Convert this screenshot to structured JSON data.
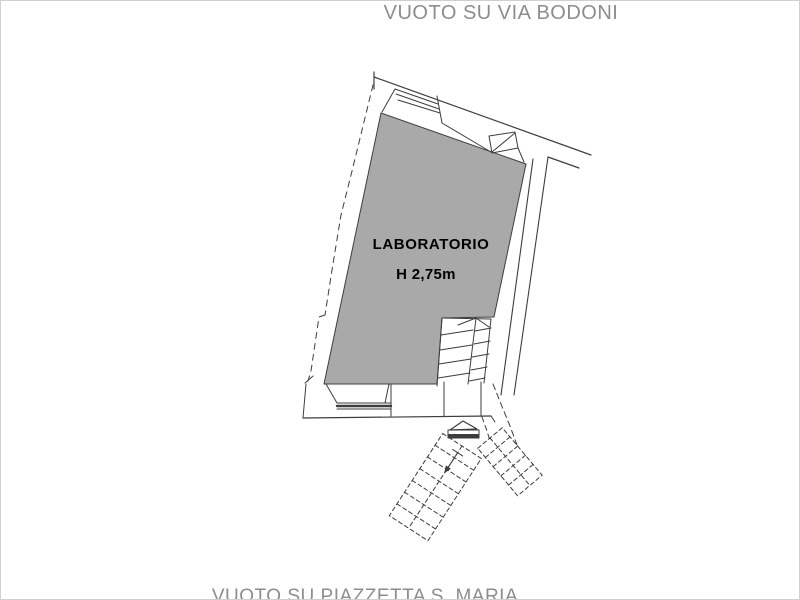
{
  "title_labels": {
    "top": "VUOTO SU VIA BODONI",
    "bottom": "VUOTO SU PIAZZETTA S. MARIA"
  },
  "room": {
    "name": "LABORATORIO",
    "height_annotation": "H 2,75m"
  },
  "colors": {
    "background": "#ffffff",
    "room_fill": "#a9a9a9",
    "line": "#3d3d3d",
    "label_text": "#8d8d8d",
    "room_text": "#000000",
    "frame_border": "#cfcfcf"
  }
}
